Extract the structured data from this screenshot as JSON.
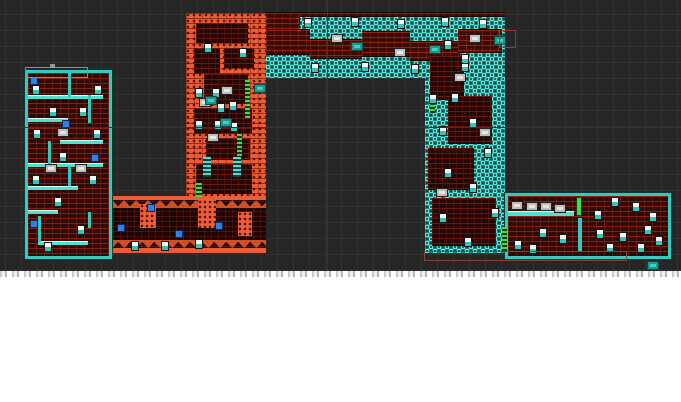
{
  "window": {
    "canvas_width": 681,
    "canvas_height": 271,
    "grid": {
      "cell": 16,
      "offset_x": 5,
      "offset_y": 14,
      "line_color": "#313131",
      "bg_color": "#262626"
    },
    "below_canvas": "white"
  },
  "palette": {
    "teal": "#38c9be",
    "teal_light": "#6fe9dd",
    "teal_dark": "#17867d",
    "orange": "#ea5d36",
    "brick_red": "#8a2110",
    "brick_bg": "#2e0a05",
    "guide_red": "#701b13",
    "guide_blue": "#2b2e96",
    "green": "#45d94f"
  },
  "map": {
    "segments": [
      {
        "cls": "tealcheck",
        "name": "right-shaft",
        "x": 425,
        "y": 13,
        "w": 80,
        "h": 240
      },
      {
        "cls": "tealcheck",
        "name": "top-corridor",
        "x": 266,
        "y": 13,
        "w": 239,
        "h": 65
      },
      {
        "cls": "orangebrick",
        "name": "orange-shaft",
        "x": 186,
        "y": 13,
        "w": 80,
        "h": 187
      },
      {
        "cls": "seg-cave",
        "name": "lower-left-corridor",
        "x": 106,
        "y": 196,
        "w": 160,
        "h": 57
      },
      {
        "cls": "seg-room",
        "name": "left-tower-room",
        "x": 25,
        "y": 70,
        "w": 81,
        "h": 183
      },
      {
        "cls": "seg-room",
        "name": "bottom-right-hall",
        "x": 505,
        "y": 193,
        "w": 160,
        "h": 60
      }
    ],
    "details": [
      {
        "cls": "rock-band",
        "name": "corridor-top-patch",
        "x": 266,
        "y": 13,
        "w": 34,
        "h": 18
      },
      {
        "cls": "rock-band",
        "name": "corridor-top-strip",
        "x": 300,
        "y": 13,
        "w": 205,
        "h": 3
      },
      {
        "cls": "rock-band",
        "name": "corridor-rock",
        "x": 266,
        "y": 30,
        "w": 44,
        "h": 24
      },
      {
        "cls": "rock-band",
        "name": "corridor-rock",
        "x": 310,
        "y": 40,
        "w": 52,
        "h": 18
      },
      {
        "cls": "rock-band",
        "name": "corridor-rock",
        "x": 362,
        "y": 32,
        "w": 48,
        "h": 24
      },
      {
        "cls": "rock-band",
        "name": "corridor-rock",
        "x": 410,
        "y": 42,
        "w": 50,
        "h": 18
      },
      {
        "cls": "rock-band",
        "name": "corridor-rock",
        "x": 458,
        "y": 30,
        "w": 44,
        "h": 22
      },
      {
        "cls": "dark-pocket",
        "name": "shaft-pocket",
        "x": 196,
        "y": 23,
        "w": 52,
        "h": 20
      },
      {
        "cls": "dark-pocket",
        "name": "shaft-pocket",
        "x": 194,
        "y": 48,
        "w": 26,
        "h": 26
      },
      {
        "cls": "dark-pocket",
        "name": "shaft-pocket",
        "x": 224,
        "y": 48,
        "w": 30,
        "h": 20
      },
      {
        "cls": "dark-pocket",
        "name": "shaft-pocket",
        "x": 204,
        "y": 74,
        "w": 44,
        "h": 30
      },
      {
        "cls": "dark-pocket",
        "name": "shaft-pocket",
        "x": 194,
        "y": 108,
        "w": 58,
        "h": 26
      },
      {
        "cls": "dark-pocket",
        "name": "shaft-pocket",
        "x": 206,
        "y": 138,
        "w": 44,
        "h": 22
      },
      {
        "cls": "dark-pocket",
        "name": "shaft-pocket",
        "x": 196,
        "y": 164,
        "w": 56,
        "h": 30
      },
      {
        "cls": "dark-pocket",
        "name": "right-shaft-pocket",
        "x": 430,
        "y": 56,
        "w": 34,
        "h": 44
      },
      {
        "cls": "dark-pocket",
        "name": "right-shaft-pocket",
        "x": 448,
        "y": 96,
        "w": 44,
        "h": 48
      },
      {
        "cls": "dark-pocket",
        "name": "right-shaft-pocket",
        "x": 428,
        "y": 148,
        "w": 46,
        "h": 42
      },
      {
        "cls": "dark-pocket",
        "name": "right-shaft-pocket",
        "x": 432,
        "y": 198,
        "w": 64,
        "h": 48
      },
      {
        "cls": "orange-blob",
        "name": "cave-stalagmite",
        "x": 140,
        "y": 204,
        "w": 16,
        "h": 24
      },
      {
        "cls": "orange-blob",
        "name": "cave-stalagmite",
        "x": 198,
        "y": 200,
        "w": 18,
        "h": 28
      },
      {
        "cls": "orange-blob",
        "name": "cave-stalagmite",
        "x": 238,
        "y": 212,
        "w": 14,
        "h": 24
      },
      {
        "cls": "platform",
        "name": "tower-platform",
        "x": 28,
        "y": 95,
        "w": 75,
        "h": 3
      },
      {
        "cls": "platform",
        "name": "tower-platform",
        "x": 28,
        "y": 118,
        "w": 40,
        "h": 3
      },
      {
        "cls": "platform",
        "name": "tower-platform",
        "x": 60,
        "y": 140,
        "w": 43,
        "h": 3
      },
      {
        "cls": "platform",
        "name": "tower-platform",
        "x": 28,
        "y": 163,
        "w": 75,
        "h": 3
      },
      {
        "cls": "platform",
        "name": "tower-platform",
        "x": 28,
        "y": 186,
        "w": 50,
        "h": 3
      },
      {
        "cls": "platform",
        "name": "tower-platform",
        "x": 28,
        "y": 210,
        "w": 30,
        "h": 3
      },
      {
        "cls": "platform",
        "name": "tower-platform",
        "x": 38,
        "y": 241,
        "w": 50,
        "h": 3
      },
      {
        "cls": "wall-teal",
        "name": "tower-wall",
        "x": 68,
        "y": 73,
        "w": 3,
        "h": 24
      },
      {
        "cls": "wall-teal",
        "name": "tower-wall",
        "x": 88,
        "y": 95,
        "w": 3,
        "h": 28
      },
      {
        "cls": "wall-teal",
        "name": "tower-wall",
        "x": 48,
        "y": 141,
        "w": 3,
        "h": 24
      },
      {
        "cls": "wall-teal",
        "name": "tower-wall",
        "x": 68,
        "y": 166,
        "w": 3,
        "h": 20
      },
      {
        "cls": "wall-teal",
        "name": "tower-wall",
        "x": 38,
        "y": 216,
        "w": 3,
        "h": 26
      },
      {
        "cls": "wall-teal",
        "name": "tower-wall",
        "x": 88,
        "y": 212,
        "w": 3,
        "h": 16
      },
      {
        "cls": "platform",
        "name": "hall-platform",
        "x": 508,
        "y": 211,
        "w": 66,
        "h": 4
      },
      {
        "cls": "wall-teal",
        "name": "hall-divider",
        "x": 578,
        "y": 218,
        "w": 4,
        "h": 33
      },
      {
        "cls": "door-green",
        "name": "hall-door",
        "x": 576,
        "y": 197,
        "w": 6,
        "h": 19
      },
      {
        "cls": "ladder-green",
        "name": "ladder",
        "x": 245,
        "y": 80,
        "w": 5,
        "h": 38
      },
      {
        "cls": "ladder-green",
        "name": "ladder",
        "x": 237,
        "y": 134,
        "w": 5,
        "h": 22
      },
      {
        "cls": "ladder-green",
        "name": "ladder",
        "x": 196,
        "y": 183,
        "w": 6,
        "h": 14
      },
      {
        "cls": "ladder-green",
        "name": "ladder",
        "x": 430,
        "y": 101,
        "w": 5,
        "h": 13
      },
      {
        "cls": "ladder-green",
        "name": "ladder",
        "x": 502,
        "y": 227,
        "w": 5,
        "h": 24
      },
      {
        "cls": "ladder-teal",
        "name": "teal-ladder",
        "x": 203,
        "y": 157,
        "w": 8,
        "h": 20
      },
      {
        "cls": "ladder-teal",
        "name": "teal-ladder",
        "x": 233,
        "y": 157,
        "w": 8,
        "h": 20
      }
    ],
    "items": [
      {
        "cls": "orb",
        "name": "orb-item",
        "x": 31,
        "y": 78
      },
      {
        "cls": "orb",
        "name": "orb-item",
        "x": 63,
        "y": 121
      },
      {
        "cls": "orb",
        "name": "orb-item",
        "x": 92,
        "y": 155
      },
      {
        "cls": "orb",
        "name": "orb-item",
        "x": 31,
        "y": 221
      },
      {
        "cls": "orb",
        "name": "orb-item",
        "x": 148,
        "y": 205
      },
      {
        "cls": "orb",
        "name": "orb-item",
        "x": 118,
        "y": 225
      },
      {
        "cls": "orb",
        "name": "orb-item",
        "x": 176,
        "y": 231
      },
      {
        "cls": "orb",
        "name": "orb-item",
        "x": 216,
        "y": 223
      },
      {
        "cls": "candle",
        "name": "candle-sprite",
        "x": 33,
        "y": 86
      },
      {
        "cls": "candle",
        "name": "candle-sprite",
        "x": 95,
        "y": 86
      },
      {
        "cls": "candle",
        "name": "candle-sprite",
        "x": 50,
        "y": 108
      },
      {
        "cls": "candle",
        "name": "candle-sprite",
        "x": 80,
        "y": 108
      },
      {
        "cls": "candle",
        "name": "candle-sprite",
        "x": 34,
        "y": 130
      },
      {
        "cls": "candle",
        "name": "candle-sprite",
        "x": 94,
        "y": 130
      },
      {
        "cls": "candle",
        "name": "candle-sprite",
        "x": 60,
        "y": 153
      },
      {
        "cls": "candle",
        "name": "candle-sprite",
        "x": 33,
        "y": 176
      },
      {
        "cls": "candle",
        "name": "candle-sprite",
        "x": 90,
        "y": 176
      },
      {
        "cls": "candle",
        "name": "candle-sprite",
        "x": 55,
        "y": 198
      },
      {
        "cls": "candle",
        "name": "candle-sprite",
        "x": 78,
        "y": 226
      },
      {
        "cls": "candle",
        "name": "candle-sprite",
        "x": 45,
        "y": 243
      },
      {
        "cls": "candle",
        "name": "candle-sprite",
        "x": 305,
        "y": 19
      },
      {
        "cls": "candle",
        "name": "candle-sprite",
        "x": 352,
        "y": 18
      },
      {
        "cls": "candle",
        "name": "candle-sprite",
        "x": 398,
        "y": 20
      },
      {
        "cls": "candle",
        "name": "candle-sprite",
        "x": 442,
        "y": 18
      },
      {
        "cls": "candle",
        "name": "candle-sprite",
        "x": 480,
        "y": 20
      },
      {
        "cls": "candle",
        "name": "candle-sprite",
        "x": 312,
        "y": 64
      },
      {
        "cls": "candle",
        "name": "candle-sprite",
        "x": 362,
        "y": 63
      },
      {
        "cls": "candle",
        "name": "candle-sprite",
        "x": 412,
        "y": 65
      },
      {
        "cls": "candle",
        "name": "candle-sprite",
        "x": 462,
        "y": 63
      },
      {
        "cls": "candle",
        "name": "candle-sprite",
        "x": 205,
        "y": 44
      },
      {
        "cls": "candle",
        "name": "candle-sprite",
        "x": 240,
        "y": 49
      },
      {
        "cls": "candle",
        "name": "candle-sprite",
        "x": 196,
        "y": 89
      },
      {
        "cls": "candle",
        "name": "candle-sprite",
        "x": 213,
        "y": 89
      },
      {
        "cls": "candle",
        "name": "candle-sprite",
        "x": 218,
        "y": 104
      },
      {
        "cls": "candle",
        "name": "candle-sprite",
        "x": 230,
        "y": 102
      },
      {
        "cls": "candle",
        "name": "candle-sprite",
        "x": 196,
        "y": 121
      },
      {
        "cls": "candle",
        "name": "candle-sprite",
        "x": 215,
        "y": 121
      },
      {
        "cls": "candle",
        "name": "candle-sprite",
        "x": 231,
        "y": 123
      },
      {
        "cls": "candle",
        "name": "candle-sprite",
        "x": 445,
        "y": 41
      },
      {
        "cls": "candle",
        "name": "candle-sprite",
        "x": 462,
        "y": 55
      },
      {
        "cls": "candle",
        "name": "candle-sprite",
        "x": 430,
        "y": 95
      },
      {
        "cls": "candle",
        "name": "candle-sprite",
        "x": 452,
        "y": 94
      },
      {
        "cls": "candle",
        "name": "candle-sprite",
        "x": 470,
        "y": 119
      },
      {
        "cls": "candle",
        "name": "candle-sprite",
        "x": 440,
        "y": 127
      },
      {
        "cls": "candle",
        "name": "candle-sprite",
        "x": 485,
        "y": 149
      },
      {
        "cls": "candle",
        "name": "candle-sprite",
        "x": 445,
        "y": 169
      },
      {
        "cls": "candle",
        "name": "candle-sprite",
        "x": 470,
        "y": 184
      },
      {
        "cls": "candle",
        "name": "candle-sprite",
        "x": 492,
        "y": 209
      },
      {
        "cls": "candle",
        "name": "candle-sprite",
        "x": 440,
        "y": 214
      },
      {
        "cls": "candle",
        "name": "candle-sprite",
        "x": 465,
        "y": 238
      },
      {
        "cls": "candle",
        "name": "candle-sprite",
        "x": 132,
        "y": 242
      },
      {
        "cls": "candle",
        "name": "candle-sprite",
        "x": 162,
        "y": 242
      },
      {
        "cls": "candle",
        "name": "candle-sprite",
        "x": 196,
        "y": 240
      },
      {
        "cls": "candle",
        "name": "candle-sprite",
        "x": 595,
        "y": 211
      },
      {
        "cls": "candle",
        "name": "candle-sprite",
        "x": 612,
        "y": 198
      },
      {
        "cls": "candle",
        "name": "candle-sprite",
        "x": 633,
        "y": 203
      },
      {
        "cls": "candle",
        "name": "candle-sprite",
        "x": 650,
        "y": 213
      },
      {
        "cls": "candle",
        "name": "candle-sprite",
        "x": 597,
        "y": 230
      },
      {
        "cls": "candle",
        "name": "candle-sprite",
        "x": 620,
        "y": 233
      },
      {
        "cls": "candle",
        "name": "candle-sprite",
        "x": 645,
        "y": 226
      },
      {
        "cls": "candle",
        "name": "candle-sprite",
        "x": 607,
        "y": 244
      },
      {
        "cls": "candle",
        "name": "candle-sprite",
        "x": 638,
        "y": 244
      },
      {
        "cls": "candle",
        "name": "candle-sprite",
        "x": 656,
        "y": 237
      },
      {
        "cls": "candle",
        "name": "candle-sprite",
        "x": 540,
        "y": 229
      },
      {
        "cls": "candle",
        "name": "candle-sprite",
        "x": 560,
        "y": 235
      },
      {
        "cls": "candle",
        "name": "candle-sprite",
        "x": 515,
        "y": 241
      },
      {
        "cls": "candle",
        "name": "candle-sprite",
        "x": 530,
        "y": 245
      },
      {
        "cls": "item-box",
        "name": "item-box",
        "x": 46,
        "y": 165
      },
      {
        "cls": "item-box",
        "name": "item-box",
        "x": 76,
        "y": 165
      },
      {
        "cls": "item-box",
        "name": "item-box",
        "x": 58,
        "y": 129
      },
      {
        "cls": "item-box",
        "name": "item-box",
        "x": 332,
        "y": 35
      },
      {
        "cls": "item-box",
        "name": "item-box",
        "x": 395,
        "y": 49
      },
      {
        "cls": "item-box",
        "name": "item-box",
        "x": 470,
        "y": 35
      },
      {
        "cls": "item-box",
        "name": "item-box",
        "x": 200,
        "y": 99
      },
      {
        "cls": "item-box",
        "name": "item-box",
        "x": 222,
        "y": 87
      },
      {
        "cls": "item-box",
        "name": "item-box",
        "x": 208,
        "y": 134
      },
      {
        "cls": "item-box",
        "name": "item-box",
        "x": 455,
        "y": 74
      },
      {
        "cls": "item-box",
        "name": "item-box",
        "x": 480,
        "y": 129
      },
      {
        "cls": "item-box",
        "name": "item-box",
        "x": 437,
        "y": 189
      },
      {
        "cls": "item-box",
        "name": "item-box",
        "x": 512,
        "y": 202
      },
      {
        "cls": "item-box",
        "name": "item-box",
        "x": 527,
        "y": 203
      },
      {
        "cls": "item-box",
        "name": "item-box",
        "x": 541,
        "y": 203
      },
      {
        "cls": "item-box",
        "name": "item-box",
        "x": 555,
        "y": 205
      },
      {
        "cls": "machine",
        "name": "machine-tile",
        "x": 352,
        "y": 43
      },
      {
        "cls": "machine",
        "name": "machine-tile",
        "x": 430,
        "y": 46
      },
      {
        "cls": "machine",
        "name": "machine-tile",
        "x": 255,
        "y": 85
      },
      {
        "cls": "machine",
        "name": "machine-tile",
        "x": 221,
        "y": 119
      },
      {
        "cls": "machine",
        "name": "machine-tile",
        "x": 206,
        "y": 97
      },
      {
        "cls": "machine",
        "name": "machine-tile",
        "x": 495,
        "y": 37
      },
      {
        "cls": "machine",
        "name": "stray-tile",
        "x": 648,
        "y": 262
      }
    ],
    "guides": [
      {
        "cls": "gray-bracket",
        "name": "room-bounds-outline",
        "x": 25,
        "y": 67,
        "w": 61,
        "h": 9
      },
      {
        "cls": "gray-handle",
        "name": "room-bounds-handle",
        "x": 50,
        "y": 64,
        "w": 5,
        "h": 4
      },
      {
        "cls": "sel-bracket",
        "name": "selection-bracket",
        "x": 499,
        "y": 30,
        "w": 15,
        "h": 16
      },
      {
        "cls": "sel-rect",
        "name": "selection-rect",
        "x": 424,
        "y": 251,
        "w": 201,
        "h": 8
      },
      {
        "cls": "guide-red",
        "name": "horizontal-guide-line",
        "x": 0,
        "y": 127,
        "w": 681,
        "h": 1
      },
      {
        "cls": "guide-blue",
        "name": "vertical-guide-line",
        "x": 327,
        "y": 0,
        "w": 1,
        "h": 271
      }
    ]
  }
}
